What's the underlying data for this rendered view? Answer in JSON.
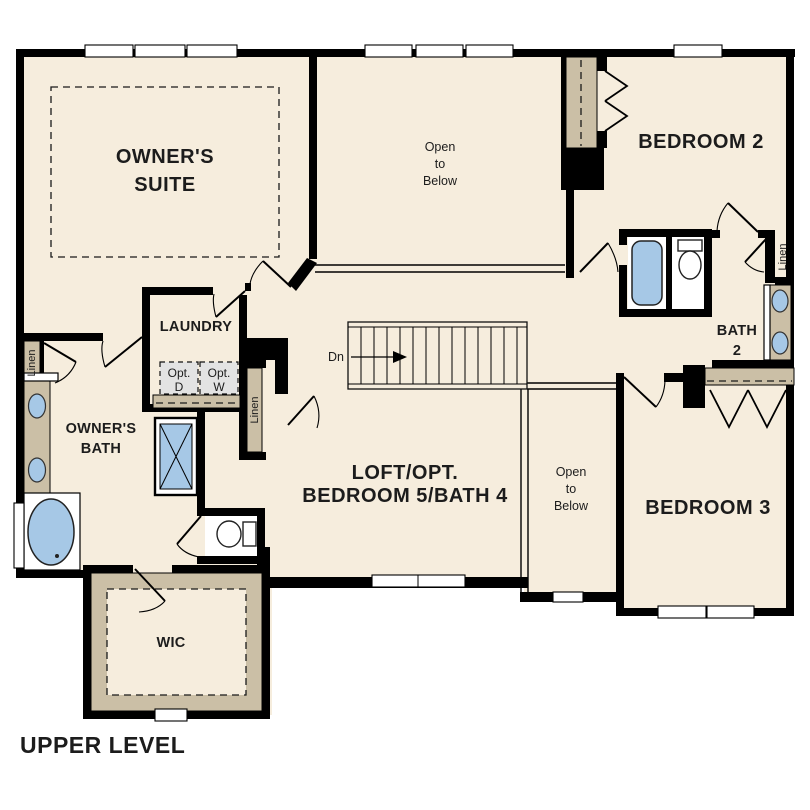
{
  "title": "UPPER LEVEL",
  "colors": {
    "floor": "#f6eddd",
    "wall": "#000000",
    "cabinet_tan": "#cbbfa6",
    "fixture_blue": "#a6c8e6",
    "optional_gray": "#e3e3e3"
  },
  "rooms": {
    "owners_suite": {
      "line1": "OWNER'S",
      "line2": "SUITE"
    },
    "open_to_below_top": {
      "line1": "Open",
      "line2": "to",
      "line3": "Below"
    },
    "bedroom2": {
      "label": "BEDROOM 2"
    },
    "laundry": {
      "label": "LAUNDRY"
    },
    "owners_bath": {
      "line1": "OWNER'S",
      "line2": "BATH"
    },
    "bath2": {
      "line1": "BATH",
      "line2": "2"
    },
    "loft": {
      "line1": "LOFT/OPT.",
      "line2": "BEDROOM 5/BATH 4"
    },
    "open_to_below_center": {
      "line1": "Open",
      "line2": "to",
      "line3": "Below"
    },
    "bedroom3": {
      "label": "BEDROOM 3"
    },
    "wic": {
      "label": "WIC"
    }
  },
  "closets": {
    "linen_left": "Linen",
    "linen_hall": "Linen",
    "linen_bath2": "Linen"
  },
  "appliances": {
    "opt_dryer": {
      "line1": "Opt.",
      "line2": "D"
    },
    "opt_washer": {
      "line1": "Opt.",
      "line2": "W"
    }
  },
  "stairs": {
    "down_label": "Dn"
  }
}
